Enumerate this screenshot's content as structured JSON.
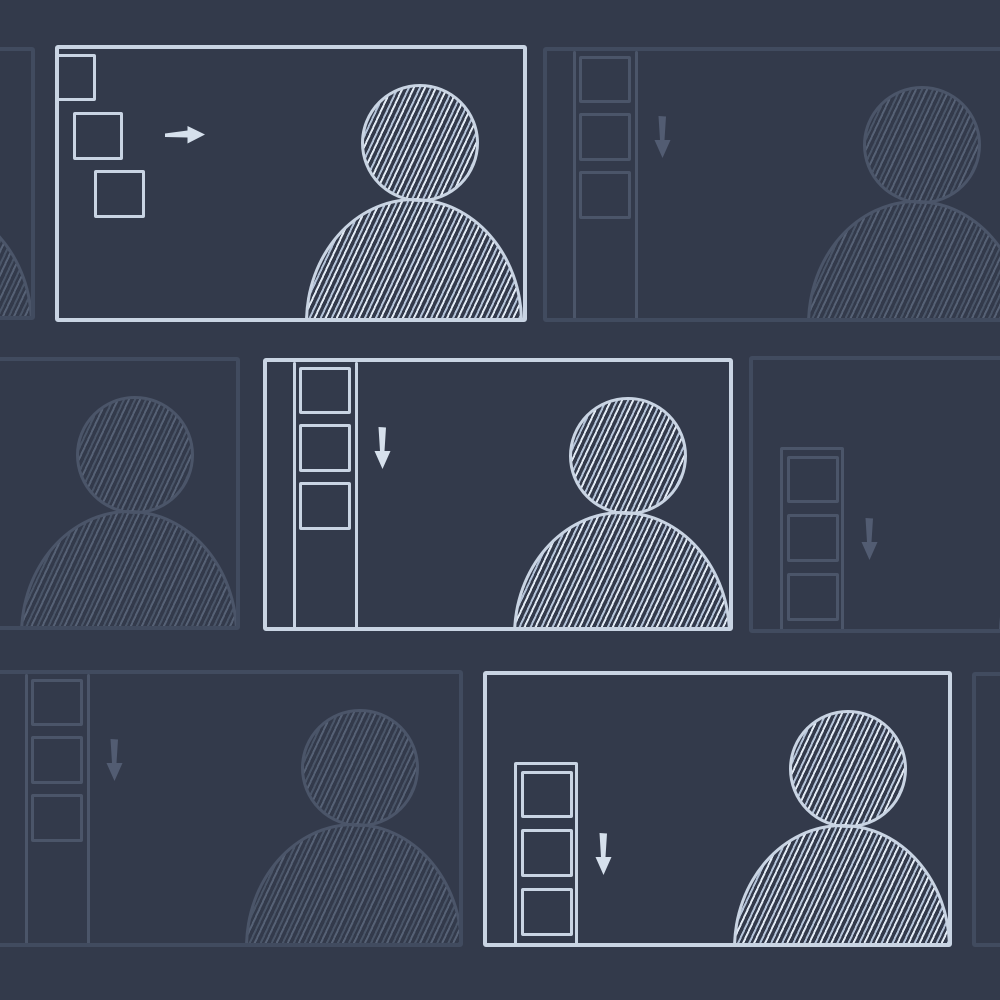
{
  "canvas": {
    "width": 1000,
    "height": 1000
  },
  "colors": {
    "background": "#333a4b",
    "bright_stroke": "#c9d4e3",
    "bright_arrow": "#d6e0ec",
    "bright_hatch": "#b4c3d8",
    "bright_hatch_light": "#e2eaf4",
    "faint_border": "#414b5f",
    "faint_stroke": "#4b5569",
    "faint_arrow": "#525c72",
    "faint_hatch": "#4a5568",
    "faint_hatch_light": "#566175"
  },
  "designs": {
    "cascade": {
      "squares": [
        {
          "x": 1,
          "y": 9,
          "w": 40,
          "h": 47
        },
        {
          "x": 18,
          "y": 67,
          "w": 50,
          "h": 48
        },
        {
          "x": 39,
          "y": 125,
          "w": 51,
          "h": 48
        }
      ],
      "arrow": {
        "dir": "right",
        "x": 110,
        "y": 79
      }
    },
    "rail": {
      "lines": [
        30,
        92
      ],
      "squares": [
        {
          "x": 36,
          "y": 9,
          "w": 52,
          "h": 47
        },
        {
          "x": 36,
          "y": 66,
          "w": 52,
          "h": 48
        },
        {
          "x": 36,
          "y": 124,
          "w": 52,
          "h": 48
        }
      ],
      "arrow": {
        "dir": "down",
        "x": 111,
        "y": 69
      }
    },
    "door": {
      "frame": {
        "x": 31,
        "y": 91,
        "w": 64
      },
      "squares": [
        {
          "x": 38,
          "y": 100,
          "w": 52,
          "h": 47
        },
        {
          "x": 38,
          "y": 158,
          "w": 52,
          "h": 48
        },
        {
          "x": 38,
          "y": 217,
          "w": 52,
          "h": 48
        }
      ],
      "arrow": {
        "dir": "down",
        "x": 112,
        "y": 162
      }
    },
    "person": {
      "head": {
        "cx": 365,
        "cy": 98,
        "r": 59
      },
      "body": {
        "x": 250,
        "w": 218,
        "top": 153
      }
    }
  },
  "panels": [
    {
      "id": "row1-left-clipped-window",
      "variant": "faint",
      "design": "rail",
      "x": -435,
      "y": 47,
      "w": 470,
      "h": 273,
      "person": true
    },
    {
      "id": "row1-focused-window",
      "variant": "bright",
      "design": "cascade",
      "x": 55,
      "y": 45,
      "w": 472,
      "h": 277,
      "person": true
    },
    {
      "id": "row1-right-window",
      "variant": "faint",
      "design": "rail",
      "x": 543,
      "y": 47,
      "w": 470,
      "h": 275,
      "person": true,
      "person_dx": 14
    },
    {
      "id": "row2-left-clipped-window",
      "variant": "faint",
      "design": "rail",
      "x": -230,
      "y": 357,
      "w": 470,
      "h": 273,
      "person": true
    },
    {
      "id": "row2-focused-window",
      "variant": "bright",
      "design": "rail",
      "x": 263,
      "y": 358,
      "w": 470,
      "h": 273,
      "person": true
    },
    {
      "id": "row2-right-clipped-window",
      "variant": "faint",
      "design": "door",
      "x": 749,
      "y": 356,
      "w": 470,
      "h": 277,
      "person": true
    },
    {
      "id": "row3-left-window",
      "variant": "faint",
      "design": "rail",
      "x": -5,
      "y": 670,
      "w": 468,
      "h": 277,
      "person": true
    },
    {
      "id": "row3-focused-window",
      "variant": "bright",
      "design": "door",
      "x": 483,
      "y": 671,
      "w": 469,
      "h": 276,
      "person": true
    },
    {
      "id": "row3-right-clipped-window",
      "variant": "faint",
      "design": "rail",
      "x": 972,
      "y": 672,
      "w": 470,
      "h": 275,
      "person": true
    }
  ]
}
